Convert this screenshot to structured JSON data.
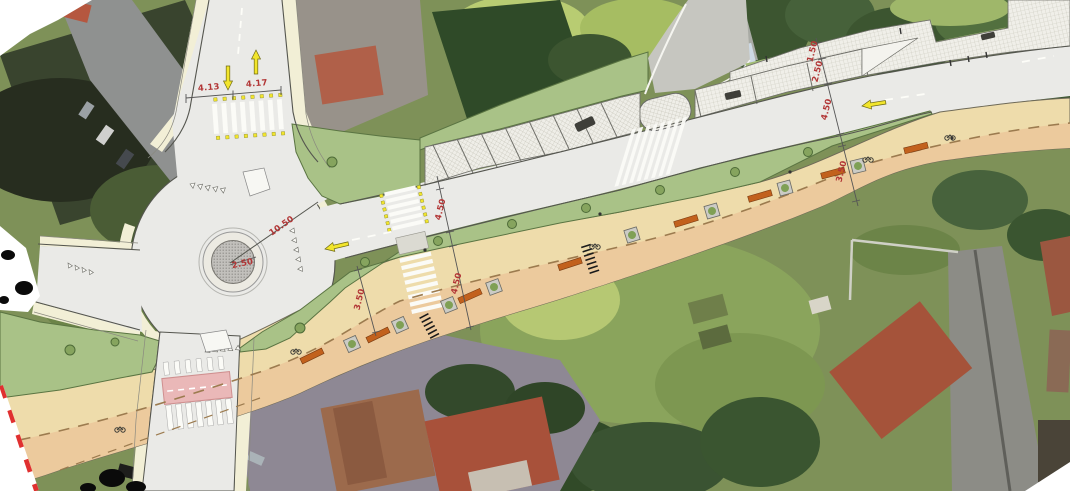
{
  "plan": {
    "dimensions": {
      "north_lane_west": "4.13",
      "north_lane_east": "4.17",
      "roundabout_radius": "10.50",
      "island_radius": "2.50",
      "carriageway_width": "4.50",
      "promenade_width": "4.50",
      "promenade_width_west": "3.50",
      "sidewalk_width_east": "1.50",
      "parking_width_east": "2.50",
      "carriageway_width_east": "4.50",
      "promenade_width_east": "3.50"
    },
    "colors": {
      "dimension_text": "#b23636",
      "plan_asphalt": "#eaeae7",
      "promenade_top": "#eedcab",
      "promenade_bottom": "#ecca9d",
      "green_area": "#a9c287",
      "green_edge": "#5a7442",
      "raised_crossing_pink": "#eab8b8",
      "marking_yellow": "#f2e52c",
      "bench_orange": "#c2611d",
      "site_boundary_red": "#e03030",
      "paver_hatch": "#f0efe9"
    },
    "symbols": {
      "direction_arrow_icon": "yellow-arrow",
      "tree_icon": "green-circle",
      "bench_icon": "orange-bar",
      "planter_icon": "gray-square-with-tree",
      "bike_rack_icon": "black-tick-row",
      "site_boundary_icon": "red-white-dashed-line"
    }
  }
}
